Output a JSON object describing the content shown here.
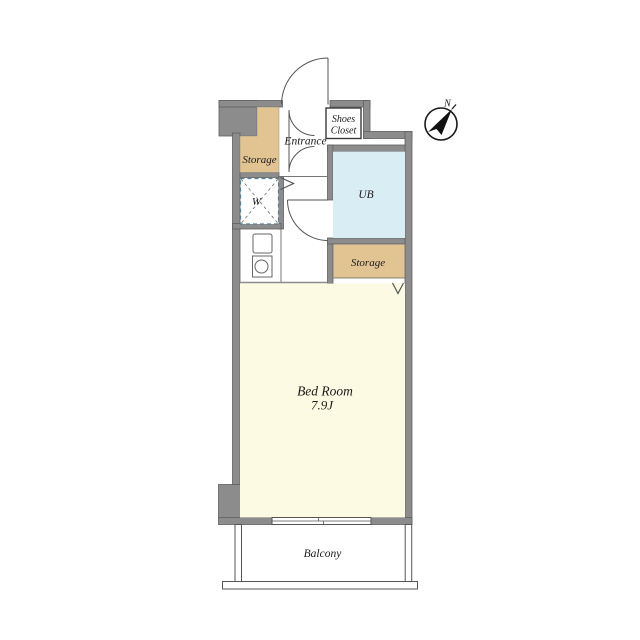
{
  "colors": {
    "wall": "#8c8c8c",
    "wall_edge": "#5f5f5f",
    "storage": "#e2c493",
    "unit_bath": "#d9edf4",
    "bedroom": "#fcfae2",
    "washer_dash": "#557f91",
    "line": "#555555",
    "text": "#1b1b1b",
    "background": "#ffffff"
  },
  "rooms": {
    "storage_left": {
      "label": "Storage"
    },
    "entrance": {
      "label": "Entrance"
    },
    "shoes_closet": {
      "label_line1": "Shoes",
      "label_line2": "Closet"
    },
    "unit_bath": {
      "label": "UB"
    },
    "washer": {
      "label": "W"
    },
    "storage_right": {
      "label": "Storage"
    },
    "bedroom": {
      "label": "Bed Room",
      "size": "7.9J"
    },
    "balcony": {
      "label": "Balcony"
    }
  },
  "compass": {
    "label": "N"
  }
}
